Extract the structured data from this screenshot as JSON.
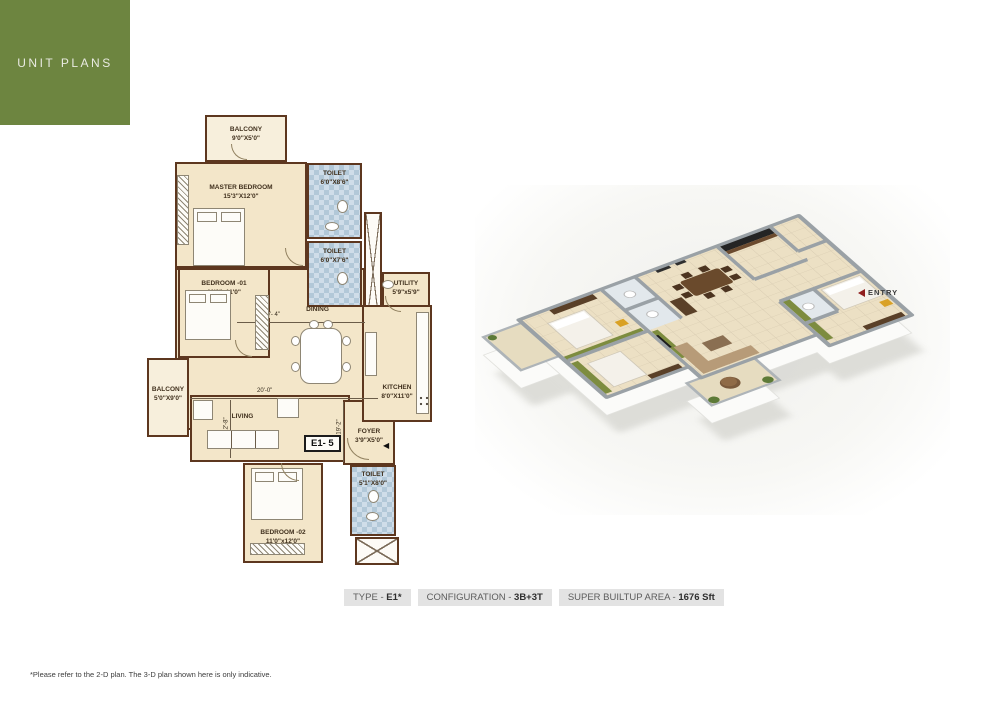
{
  "header": {
    "title": "UNIT PLANS"
  },
  "plan2d": {
    "rooms": {
      "balcony_top": {
        "name": "BALCONY",
        "dims": "9'0\"X5'0\""
      },
      "master_bedroom": {
        "name": "MASTER BEDROOM",
        "dims": "15'3\"X12'0\""
      },
      "toilet_master": {
        "name": "TOILET",
        "dims": "6'0\"X8'6\""
      },
      "toilet_common": {
        "name": "TOILET",
        "dims": "6'0\"X7'6\""
      },
      "utility": {
        "name": "UTILITY",
        "dims": "5'9\"x5'9\""
      },
      "kitchen": {
        "name": "KITCHEN",
        "dims": "8'0\"X11'0\""
      },
      "bedroom_01": {
        "name": "BEDROOM -01",
        "dims": "11'0\"x11'0\""
      },
      "dining": {
        "name": "DINING"
      },
      "living": {
        "name": "LIVING"
      },
      "balcony_left": {
        "name": "BALCONY",
        "dims": "5'0\"X9'0\""
      },
      "foyer": {
        "name": "FOYER",
        "dims": "3'9\"X5'0\""
      },
      "toilet_bed2": {
        "name": "TOILET",
        "dims": "5'1\"X8'0\""
      },
      "bedroom_02": {
        "name": "BEDROOM -02",
        "dims": "11'0\"x12'0\""
      }
    },
    "dims": {
      "dining_width": "10'- 4\"",
      "living_width": "20'-0\"",
      "living_depth": "12'-8\"",
      "hall_depth": "19'-2\""
    },
    "unit_label": "E1- 5"
  },
  "plan3d": {
    "entry_label": "ENTRY"
  },
  "info_bar": [
    {
      "label": "TYPE - ",
      "value": "E1*"
    },
    {
      "label": "CONFIGURATION - ",
      "value": "3B+3T"
    },
    {
      "label": "SUPER BUILTUP AREA - ",
      "value": "1676 Sft"
    }
  ],
  "footnote": "*Please refer to the 2-D plan. The 3-D plan shown here is only indicative.",
  "colors": {
    "brand_green": "#6d8540",
    "wall_brown": "#5d371f",
    "floor_cream": "#f3e6c9",
    "toilet_tile_blue": "#b2c8d8",
    "accent_olive_3d": "#7d8c3f",
    "entry_red": "#8f1d1d"
  }
}
